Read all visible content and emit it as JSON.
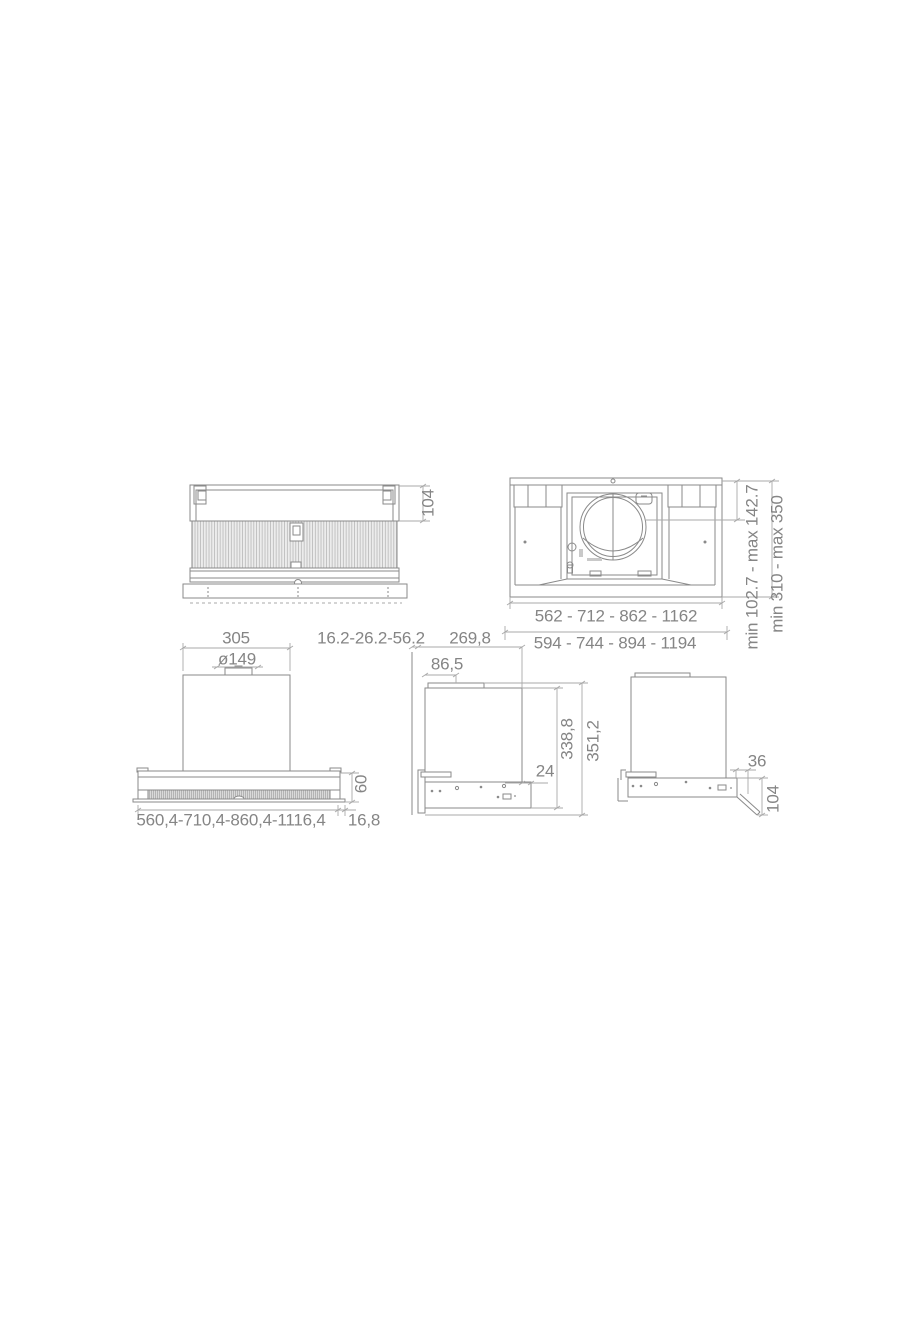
{
  "canvas": {
    "background": "#ffffff"
  },
  "drawing": {
    "kind": "technical dimension drawing (cooker hood, 5 views)",
    "colors": {
      "object_line": "#8a8a8a",
      "dimension_line": "#a9a9a9",
      "text": "#858585",
      "hatch_fill": "#ececec",
      "hatch_line": "#b8b8b8"
    },
    "views": {
      "front_panel": {
        "label": "front panel / filter view",
        "top_height": "104"
      },
      "top": {
        "label": "top view",
        "inner_width": "562 - 712 - 862 - 1162",
        "outer_width": "594 - 744 - 894 - 1194",
        "duct_center": "min 102.7 - max 142.7",
        "depth_range": "min 310 - max 350"
      },
      "front": {
        "label": "front view",
        "chimney_width": "305",
        "duct_diameter": "ø149",
        "visor_height": "60",
        "body_widths": "560,4-710,4-860,4-1116,4",
        "edge_offset": "16,8"
      },
      "side": {
        "label": "side view",
        "wall_gap": "16.2-26.2-56.2",
        "depth": "269,8",
        "collar_offset": "86,5",
        "body_height": "338,8",
        "total_height": "351,2",
        "rear_offset": "24"
      },
      "side_flap": {
        "label": "side view with open flap",
        "flap_offset": "36",
        "flap_height": "104"
      }
    }
  }
}
